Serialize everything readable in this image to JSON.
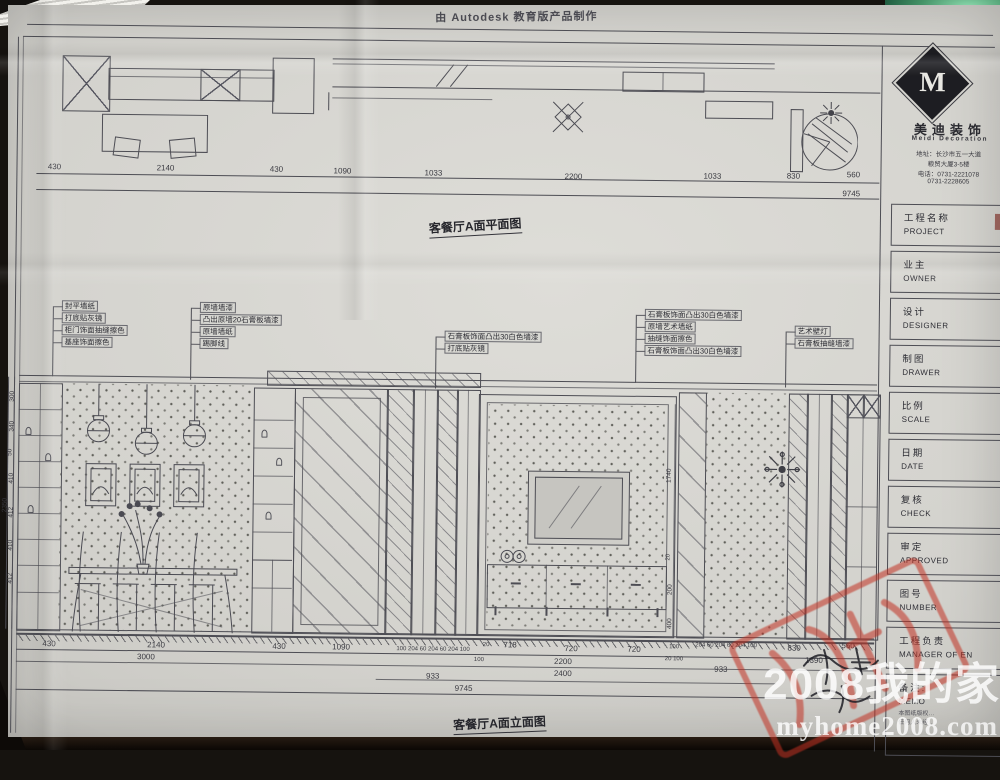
{
  "banner": {
    "autodesk": "由 Autodesk 教育版产品制作"
  },
  "plan": {
    "title": "客餐厅A面平面图",
    "dims": [
      "430",
      "2140",
      "430",
      "1090",
      "1033",
      "2200",
      "1033",
      "830",
      "560"
    ],
    "total": "9745"
  },
  "elevation": {
    "title": "客餐厅A面立面图",
    "callouts_left": [
      "封平墙纸",
      "打底贴灰镜",
      "柜门饰面抽缝擦色",
      "基座饰面擦色"
    ],
    "callouts_mid": [
      "原墙墙漆",
      "凸出原墙20石膏板墙漆",
      "原墙墙纸",
      "踢脚线"
    ],
    "callouts_center": [
      "石膏板饰面凸出30白色墙漆",
      "打底贴灰镜"
    ],
    "callouts_right": [
      "石膏板饰面凸出30白色墙漆",
      "原墙艺术墙纸",
      "抽缝饰面擦色",
      "石膏板饰面凸出30白色墙漆"
    ],
    "callouts_far_right": [
      "艺术壁灯",
      "石膏板抽缝墙漆"
    ],
    "dims_row1": [
      "430",
      "2140",
      "430",
      "1090",
      "100 204 60 204 60 204 100",
      "20",
      "718",
      "720",
      "720",
      "100",
      "204 60 204 60 204 100",
      "830",
      "560"
    ],
    "dims_row2": [
      "3000",
      "100",
      "2200",
      "20 100",
      "1390"
    ],
    "dims_row3": [
      "933",
      "2400",
      "933"
    ],
    "total": "9745",
    "vdims_left": [
      "300",
      "340",
      "50",
      "410",
      "412",
      "410",
      "412",
      "2350"
    ],
    "vdims_right": [
      "1740",
      "20",
      "200",
      "400"
    ]
  },
  "titleblock": {
    "logo_letter": "M",
    "company_cn": "美迪装饰",
    "company_en": "Meidi Decoration",
    "address_line1": "地址：长沙市五一大道",
    "address_line2": "粮贸大厦3-5楼",
    "phone_line1": "电话：0731-2221078",
    "phone_line2": "0731-2228605",
    "fields": [
      {
        "cn": "工程名称",
        "en": "PROJECT"
      },
      {
        "cn": "业主",
        "en": "OWNER"
      },
      {
        "cn": "设计",
        "en": "DESIGNER"
      },
      {
        "cn": "制图",
        "en": "DRAWER"
      },
      {
        "cn": "比例",
        "en": "SCALE"
      },
      {
        "cn": "日期",
        "en": "DATE"
      },
      {
        "cn": "复核",
        "en": "CHECK"
      },
      {
        "cn": "审定",
        "en": "APPROVED"
      },
      {
        "cn": "图号",
        "en": "NUMBER"
      },
      {
        "cn": "工程负责",
        "en": "MANAGER OF EN"
      },
      {
        "cn": "备注:",
        "en": "MEMO"
      }
    ],
    "memo_lines": [
      "本图纸版权…",
      "任何人未经…"
    ]
  },
  "watermark": {
    "line1": "2008我的家",
    "line2": "myhome2008.com"
  }
}
